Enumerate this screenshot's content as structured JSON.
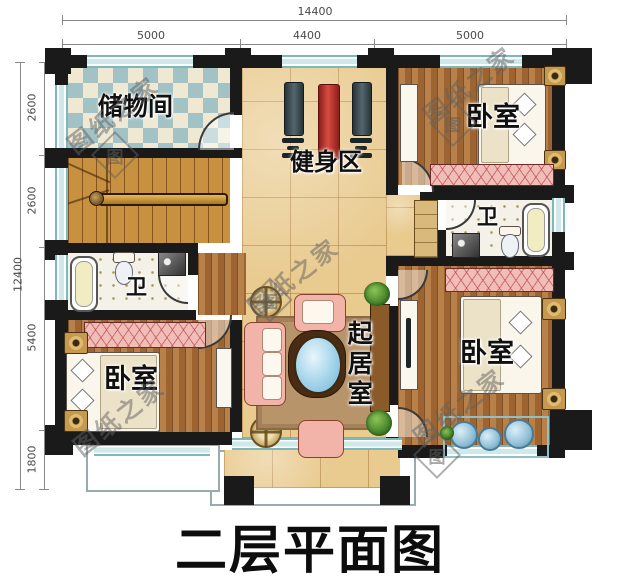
{
  "title": "二层平面图",
  "watermark": {
    "text": "图纸之家",
    "seal": "图"
  },
  "dimensions": {
    "top": {
      "total": "14400",
      "segments": [
        "5000",
        "4400",
        "5000"
      ]
    },
    "left": {
      "total": "12400",
      "segments": [
        "2600",
        "2600",
        "5400",
        "1800"
      ]
    }
  },
  "rooms": {
    "storage": "储物间",
    "gym": "健身区",
    "bedroom_ne": "卧室",
    "bedroom_se": "卧室",
    "bedroom_sw": "卧室",
    "bath_w": "卫",
    "bath_e": "卫",
    "living": "起居室"
  }
}
